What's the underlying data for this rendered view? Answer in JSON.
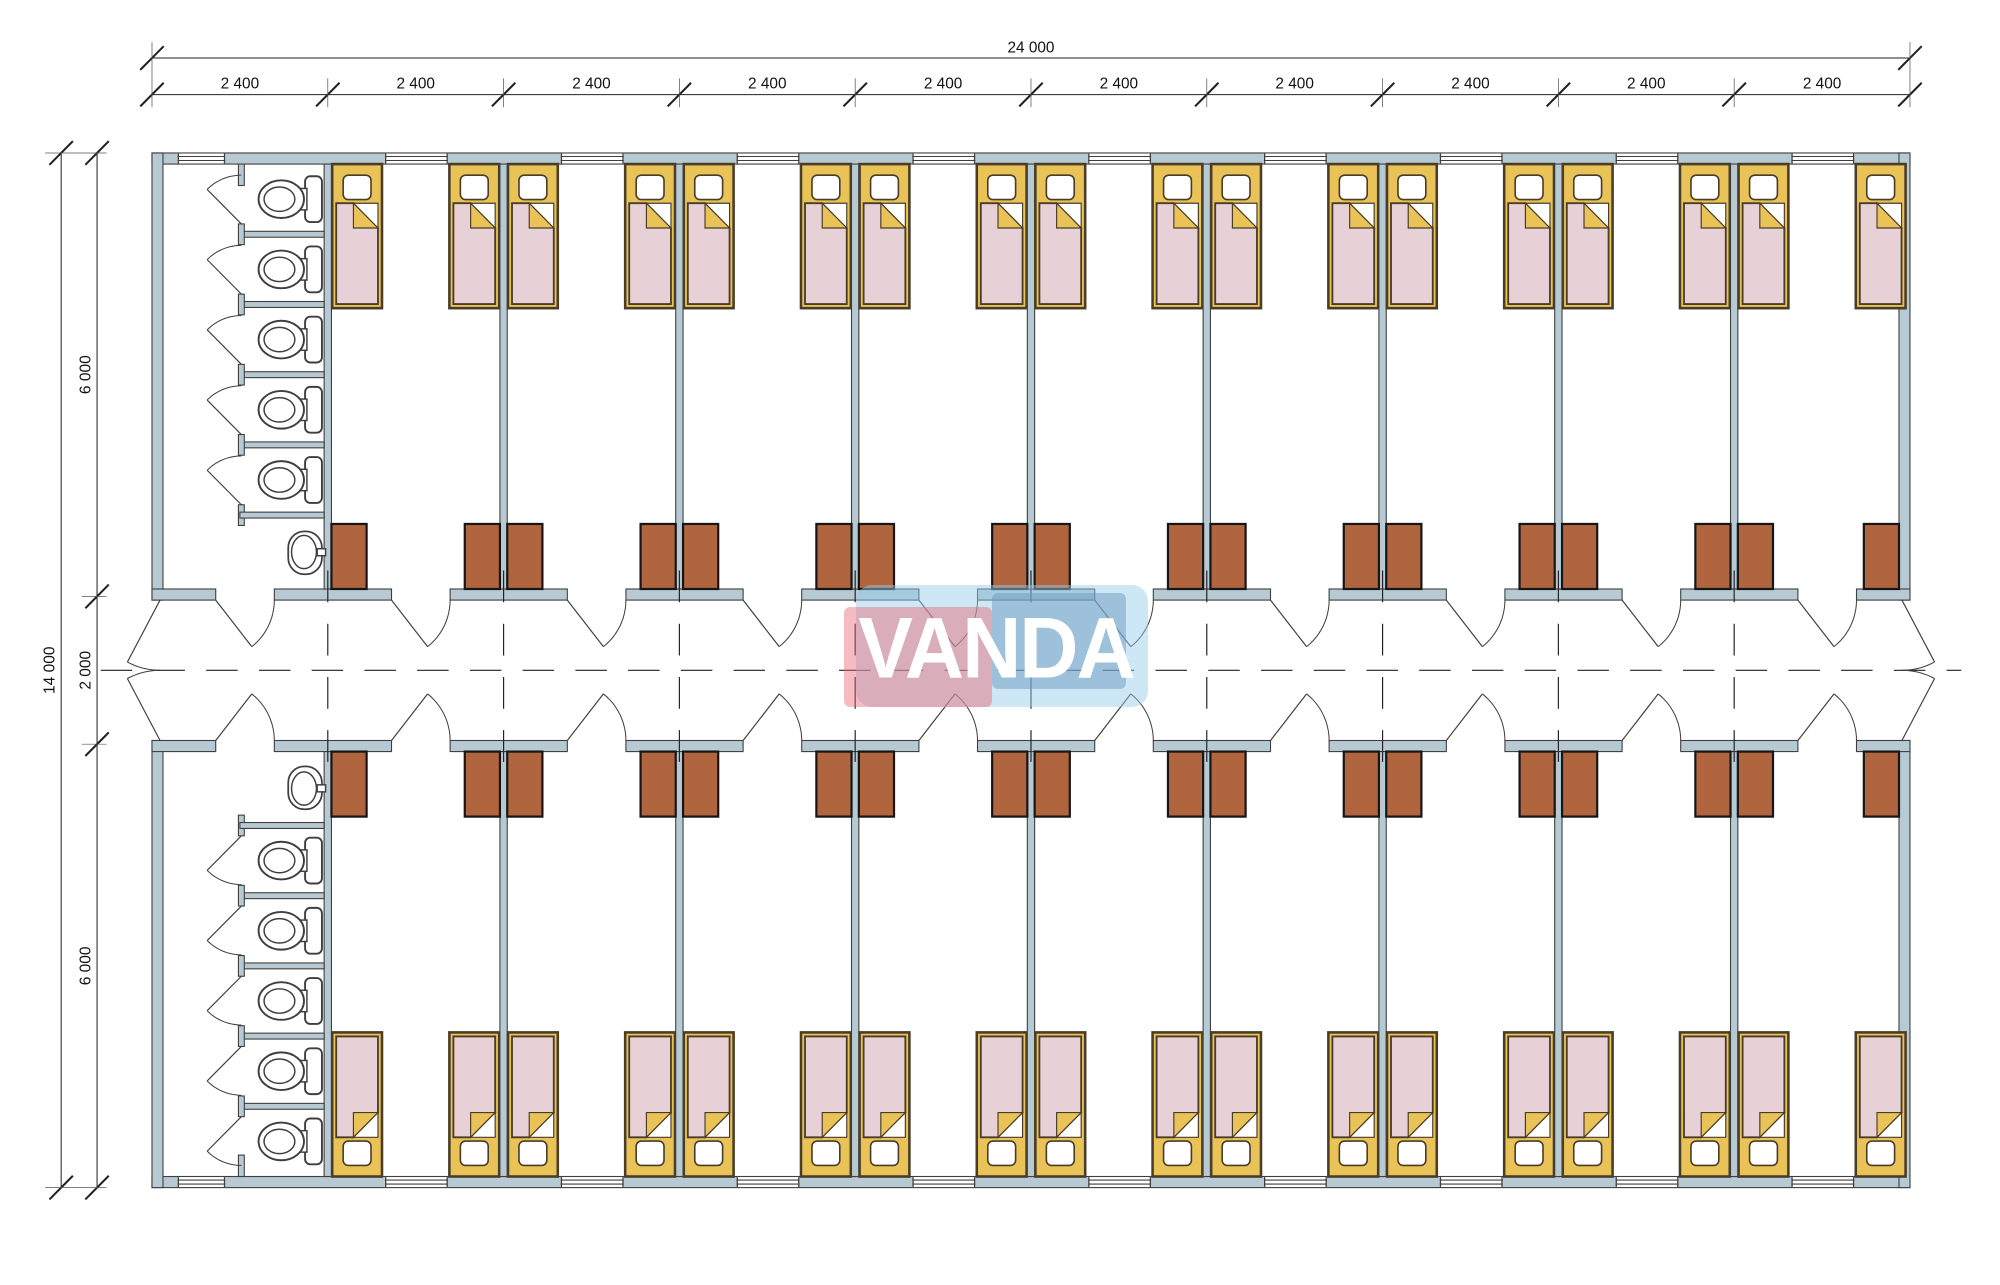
{
  "watermark": {
    "text": "VANDA",
    "pink_box_color": "rgba(232,104,116,0.45)",
    "blue_box_color": "rgba(105,150,190,0.47)",
    "bubble_color": "rgba(150,205,235,0.48)",
    "text_color": "#ffffff"
  },
  "dimensions": {
    "top_total_label": "24 000",
    "top_segment_label": "2 400",
    "top_segment_count": 10,
    "top_segment_mm": 2400,
    "left_total_label": "14 000",
    "left_segments": [
      {
        "label": "6 000",
        "mm": 6000
      },
      {
        "label": "2 000",
        "mm": 2000
      },
      {
        "label": "6 000",
        "mm": 6000
      }
    ]
  },
  "plan": {
    "building_mm": {
      "width": 24000,
      "depth": 14000
    },
    "bay_mm": 2400,
    "bays": 10,
    "corridor_mm": 2000,
    "rooms_per_side": 9,
    "beds_per_room": 2,
    "toilet_stalls_per_block": 5,
    "sinks_per_block": 1,
    "colors": {
      "line": "#3f3f3f",
      "wall_fill": "#b7cad4",
      "locker": "#b0653f",
      "bed_yellow": "#e9c258",
      "bed_blanket": "#e7d0d6",
      "bed_outline": "#4a3d28",
      "fixture_fill": "#ffffff",
      "dim_line": "#222222",
      "dim_text": "#111111"
    }
  }
}
